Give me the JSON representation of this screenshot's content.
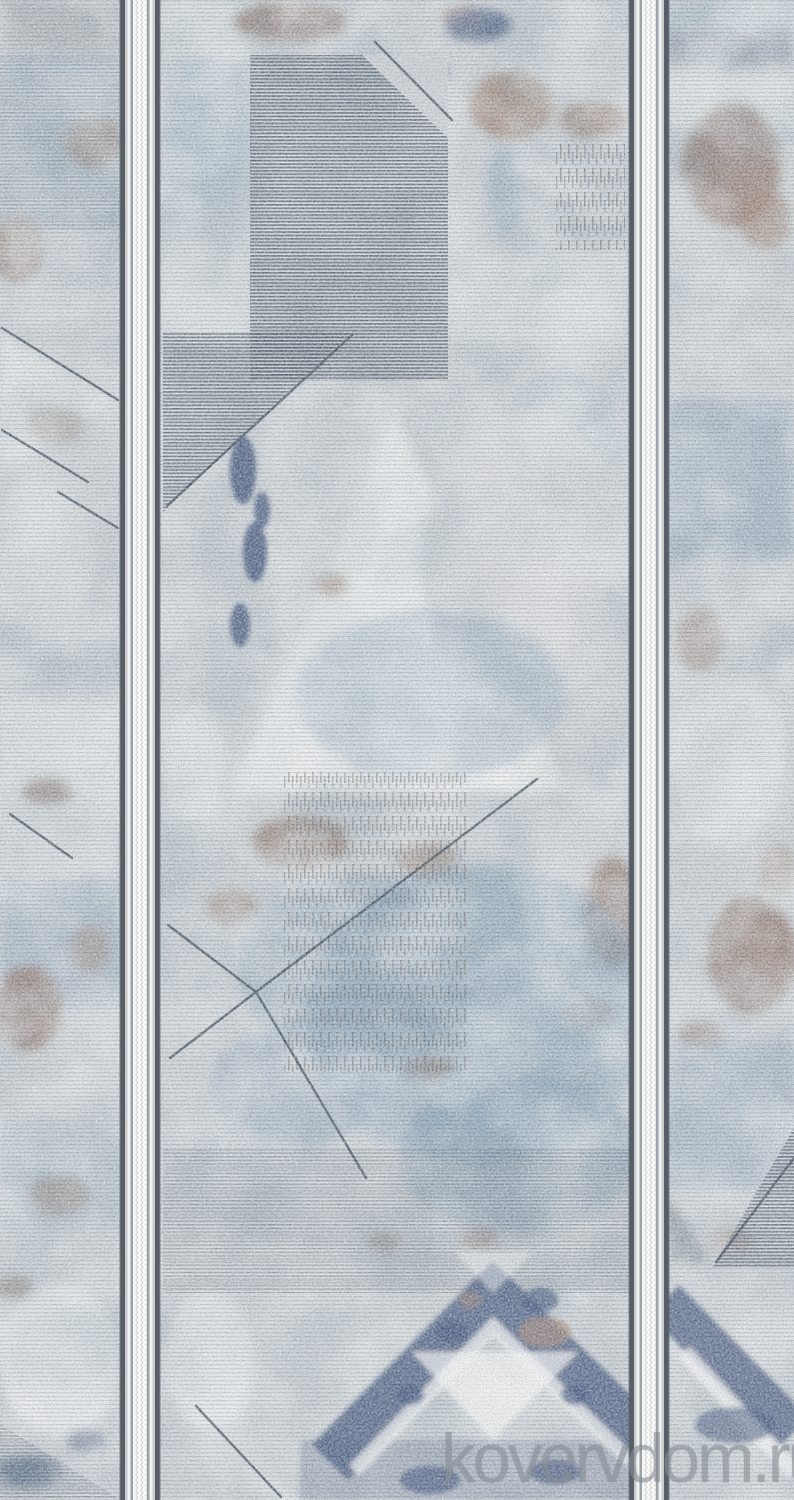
{
  "image": {
    "subject": "Distressed geometric carpet runner, pale blue-grey field with slate hatching, steel-blue washes, taupe patches, navy chevron motifs and two vertical grey-and-white border stripes",
    "watermark": "kovervdom.ru"
  },
  "palette": {
    "base": "#cdd2d6",
    "cream": "#ecefee",
    "white": "#f4f5f4",
    "silver": "#d9dcde",
    "slate": "#4c5866",
    "slate_line": "#414d59",
    "navy": "#45577d",
    "steel": "#7e9cb4",
    "pale_blue": "#9fb6c6",
    "brown": "#8e7467",
    "taupe": "#a38b7b",
    "dark_brown": "#5a5047",
    "stripe_dark": "#575e66",
    "stripe_mid": "#9ba2a8",
    "stripe_soft": "#c6cacd",
    "stripe_light": "#f1f2f2",
    "stripe_white": "#f8f8f7",
    "watermark": "#878d95"
  }
}
